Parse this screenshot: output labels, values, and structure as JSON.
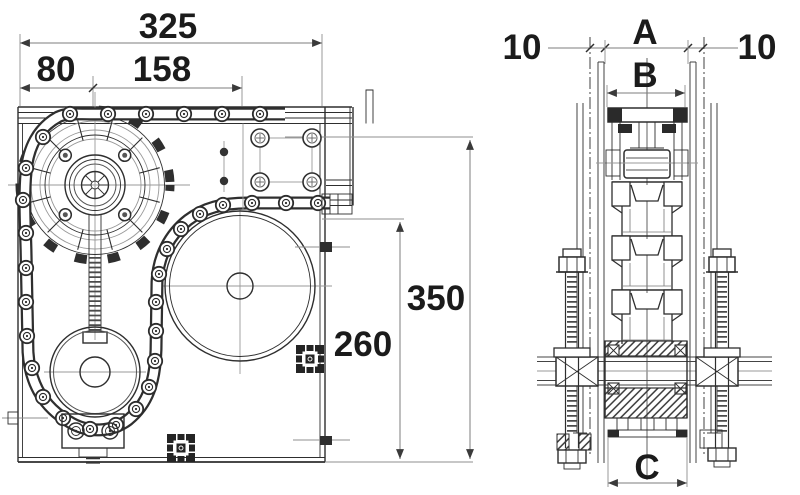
{
  "drawing": {
    "type": "technical-two-view-drawing",
    "subject": "chain-tensioner-drive-station",
    "background": "#ffffff",
    "colors": {
      "outline": "#2e2e2e",
      "fill_dark": "#242424",
      "centerline": "#9a9a9a",
      "dimension_line": "#7d7d7d",
      "text": "#1b1b1b"
    },
    "front_view": {
      "name": "front-view",
      "dimensions": {
        "overall_width": "325",
        "left_offset": "80",
        "mid_width": "158",
        "overall_height": "350",
        "inner_height": "260"
      }
    },
    "side_view": {
      "name": "side-view",
      "dimensions": {
        "overall_width": "A",
        "left_gap": "10",
        "right_gap": "10",
        "inner_width": "B",
        "hub_width": "C"
      }
    }
  }
}
